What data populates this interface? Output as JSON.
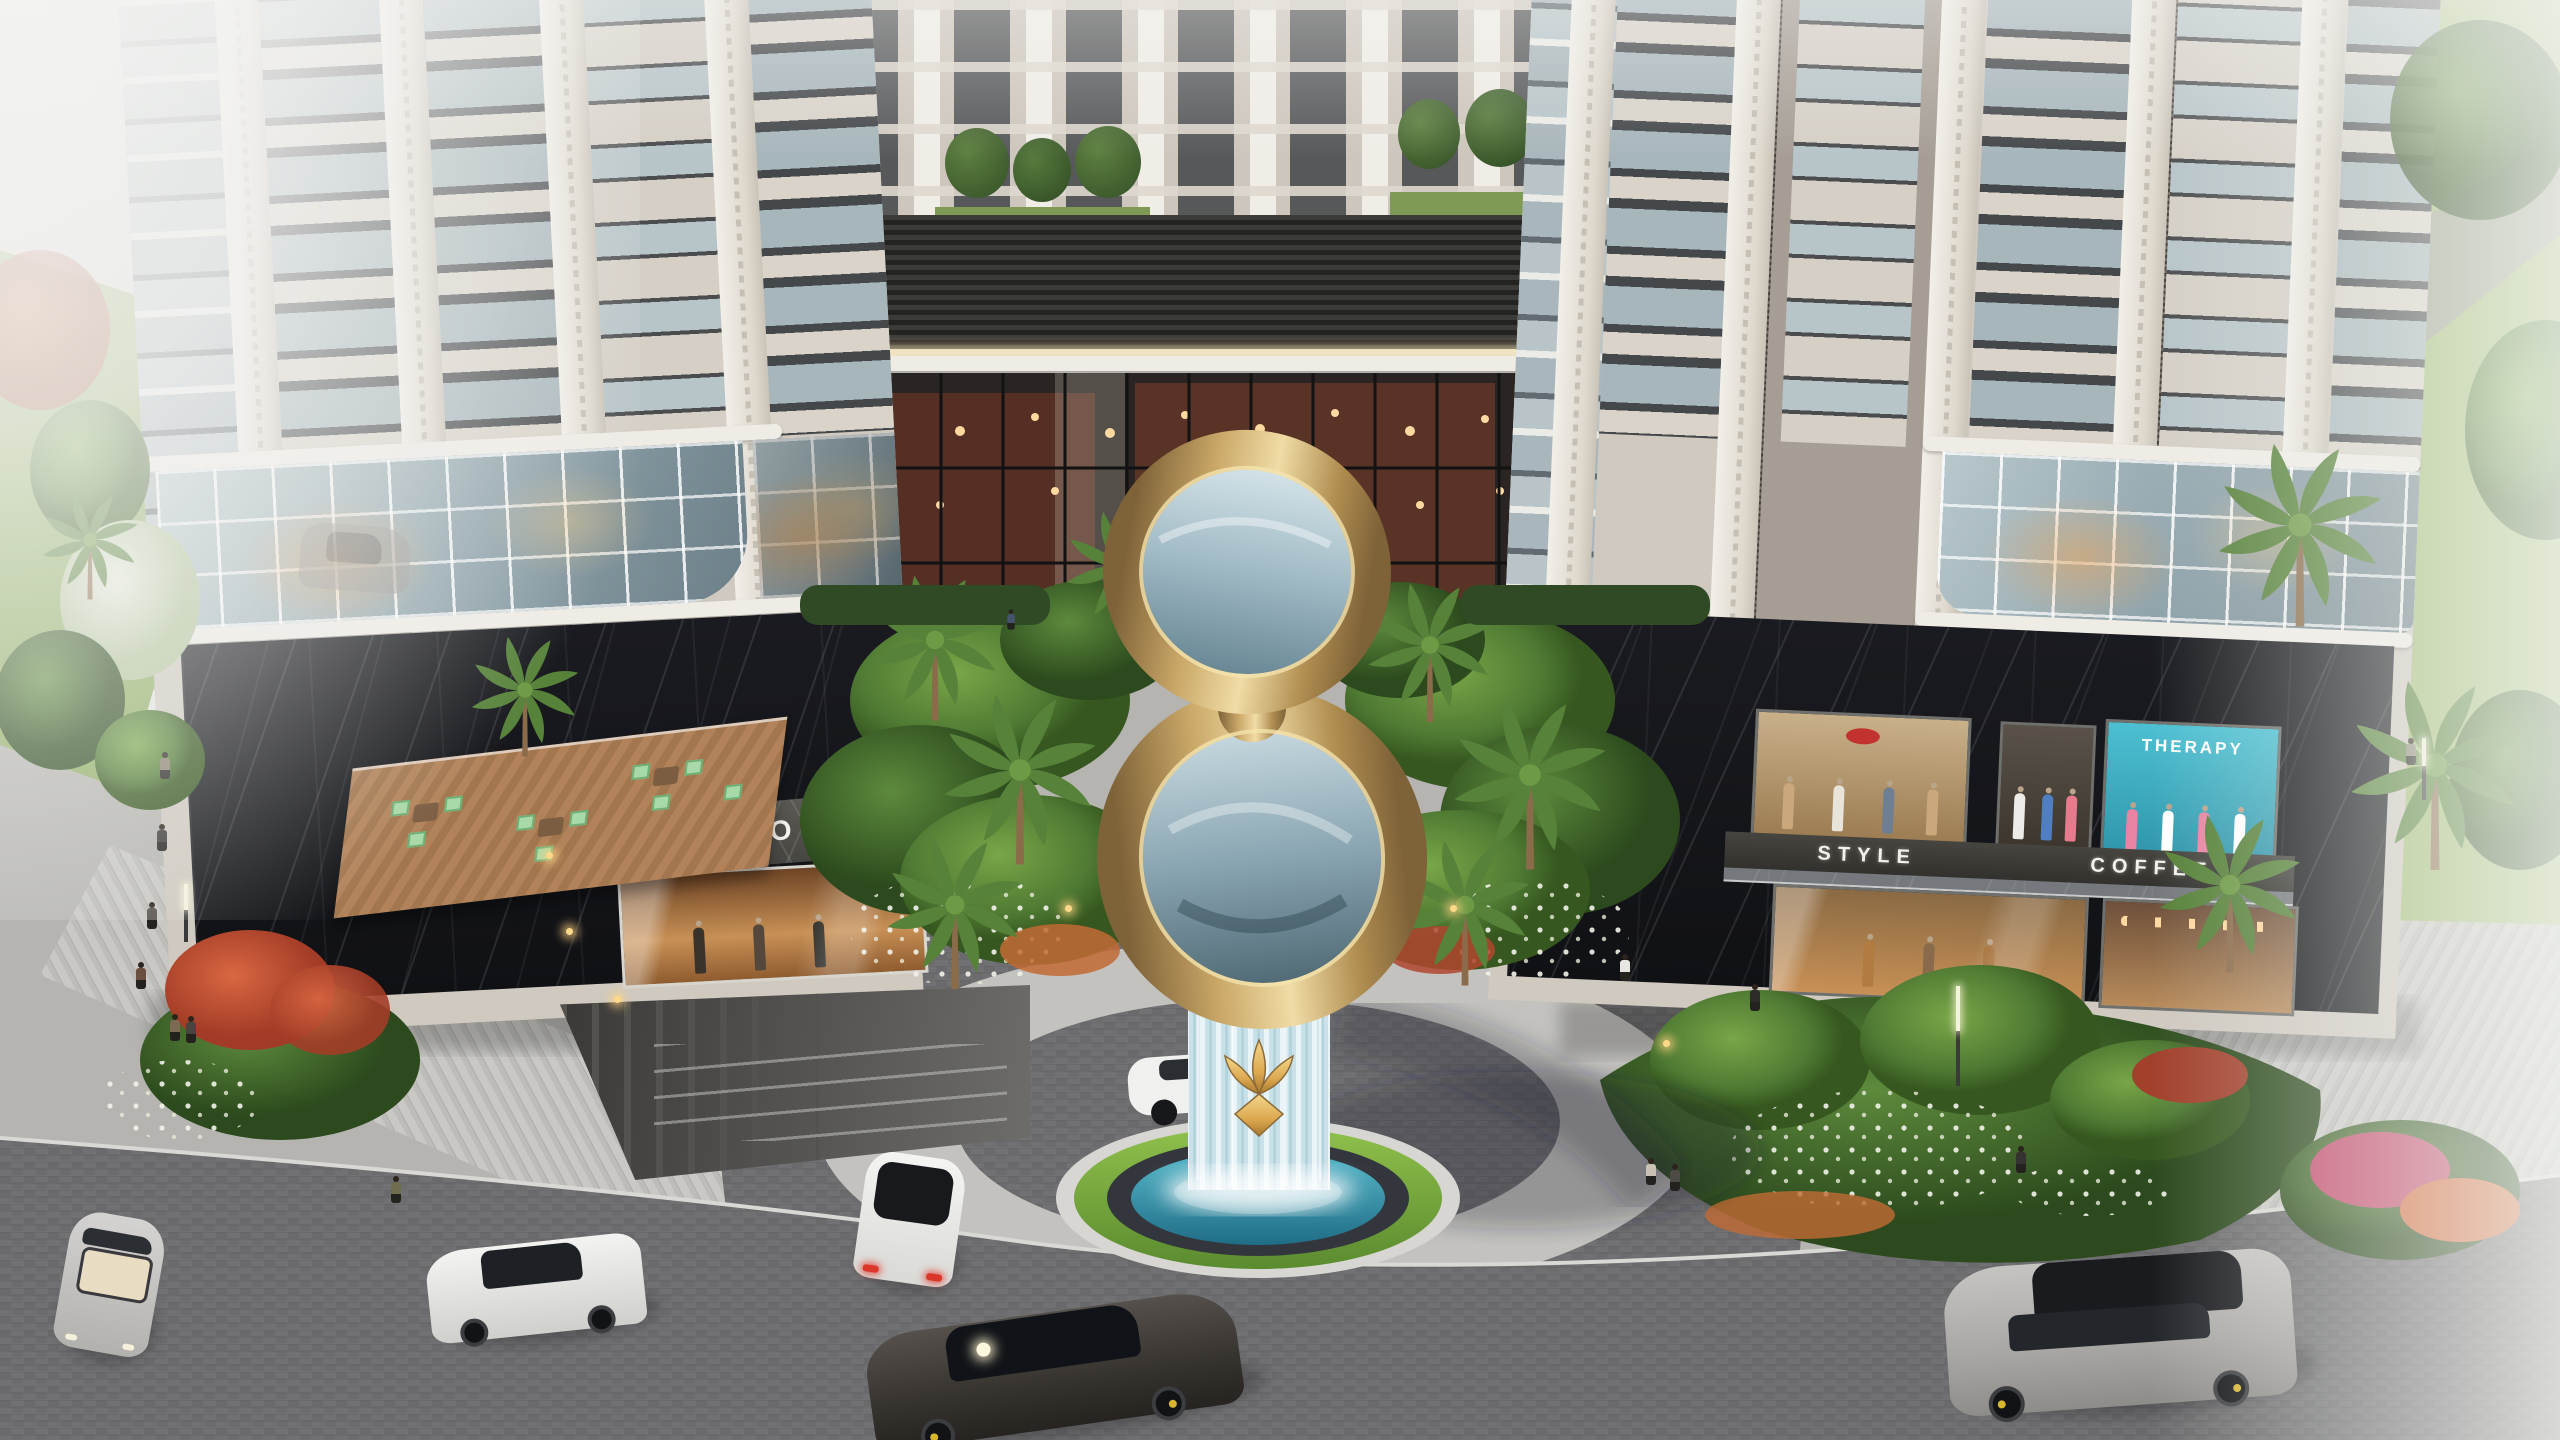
{
  "scene": {
    "type": "architectural-render",
    "description": "Aerial rendering of a twin-tower residential complex with retail podium, giant golden figure-8 ribbon sculpture above a waterfall fountain, landscaped drop-off plaza, cobbled roads, cars and pedestrians",
    "time_of_day": "daytime"
  },
  "signs": {
    "shop": "SHOP",
    "boutique": "STYLE",
    "coffee": "COFFEE",
    "therapy": "THERAPY"
  },
  "sculpture": {
    "name": "golden-ribbon-fountain",
    "emblem": "gold lotus emblem on glass waterfall pedestal",
    "pool": "circular blue pool with pebble and grass rings"
  },
  "palette": {
    "facade_cream": "#d5cfc6",
    "facade_white": "#f2efe9",
    "facade_greige": "#a69e95",
    "window_glass": "#a7b6bb",
    "marble_black": "#15161a",
    "gold": "#c3a263",
    "gold_light": "#f0dca6",
    "mirror_blue": "#9fb9c4",
    "pool_blue": "#2a7d96",
    "grass_green": "#6f9e3d",
    "palm_green": "#57823a",
    "road_cobble": "#717173",
    "paving_light": "#c8c7c3",
    "terrace_wood": "#ab7e55",
    "chair_mint": "#a8d9a8",
    "interior_warm": "#c8763a",
    "therapy_teal": "#3fb0c4"
  },
  "vehicles": [
    "faded grey car",
    "white hatchback",
    "silver convertible",
    "white sedan",
    "dark grey sports sedan",
    "white car at fountain",
    "grey sports wagon"
  ],
  "pedestrian_count": 14,
  "palm_tree_count": 12
}
